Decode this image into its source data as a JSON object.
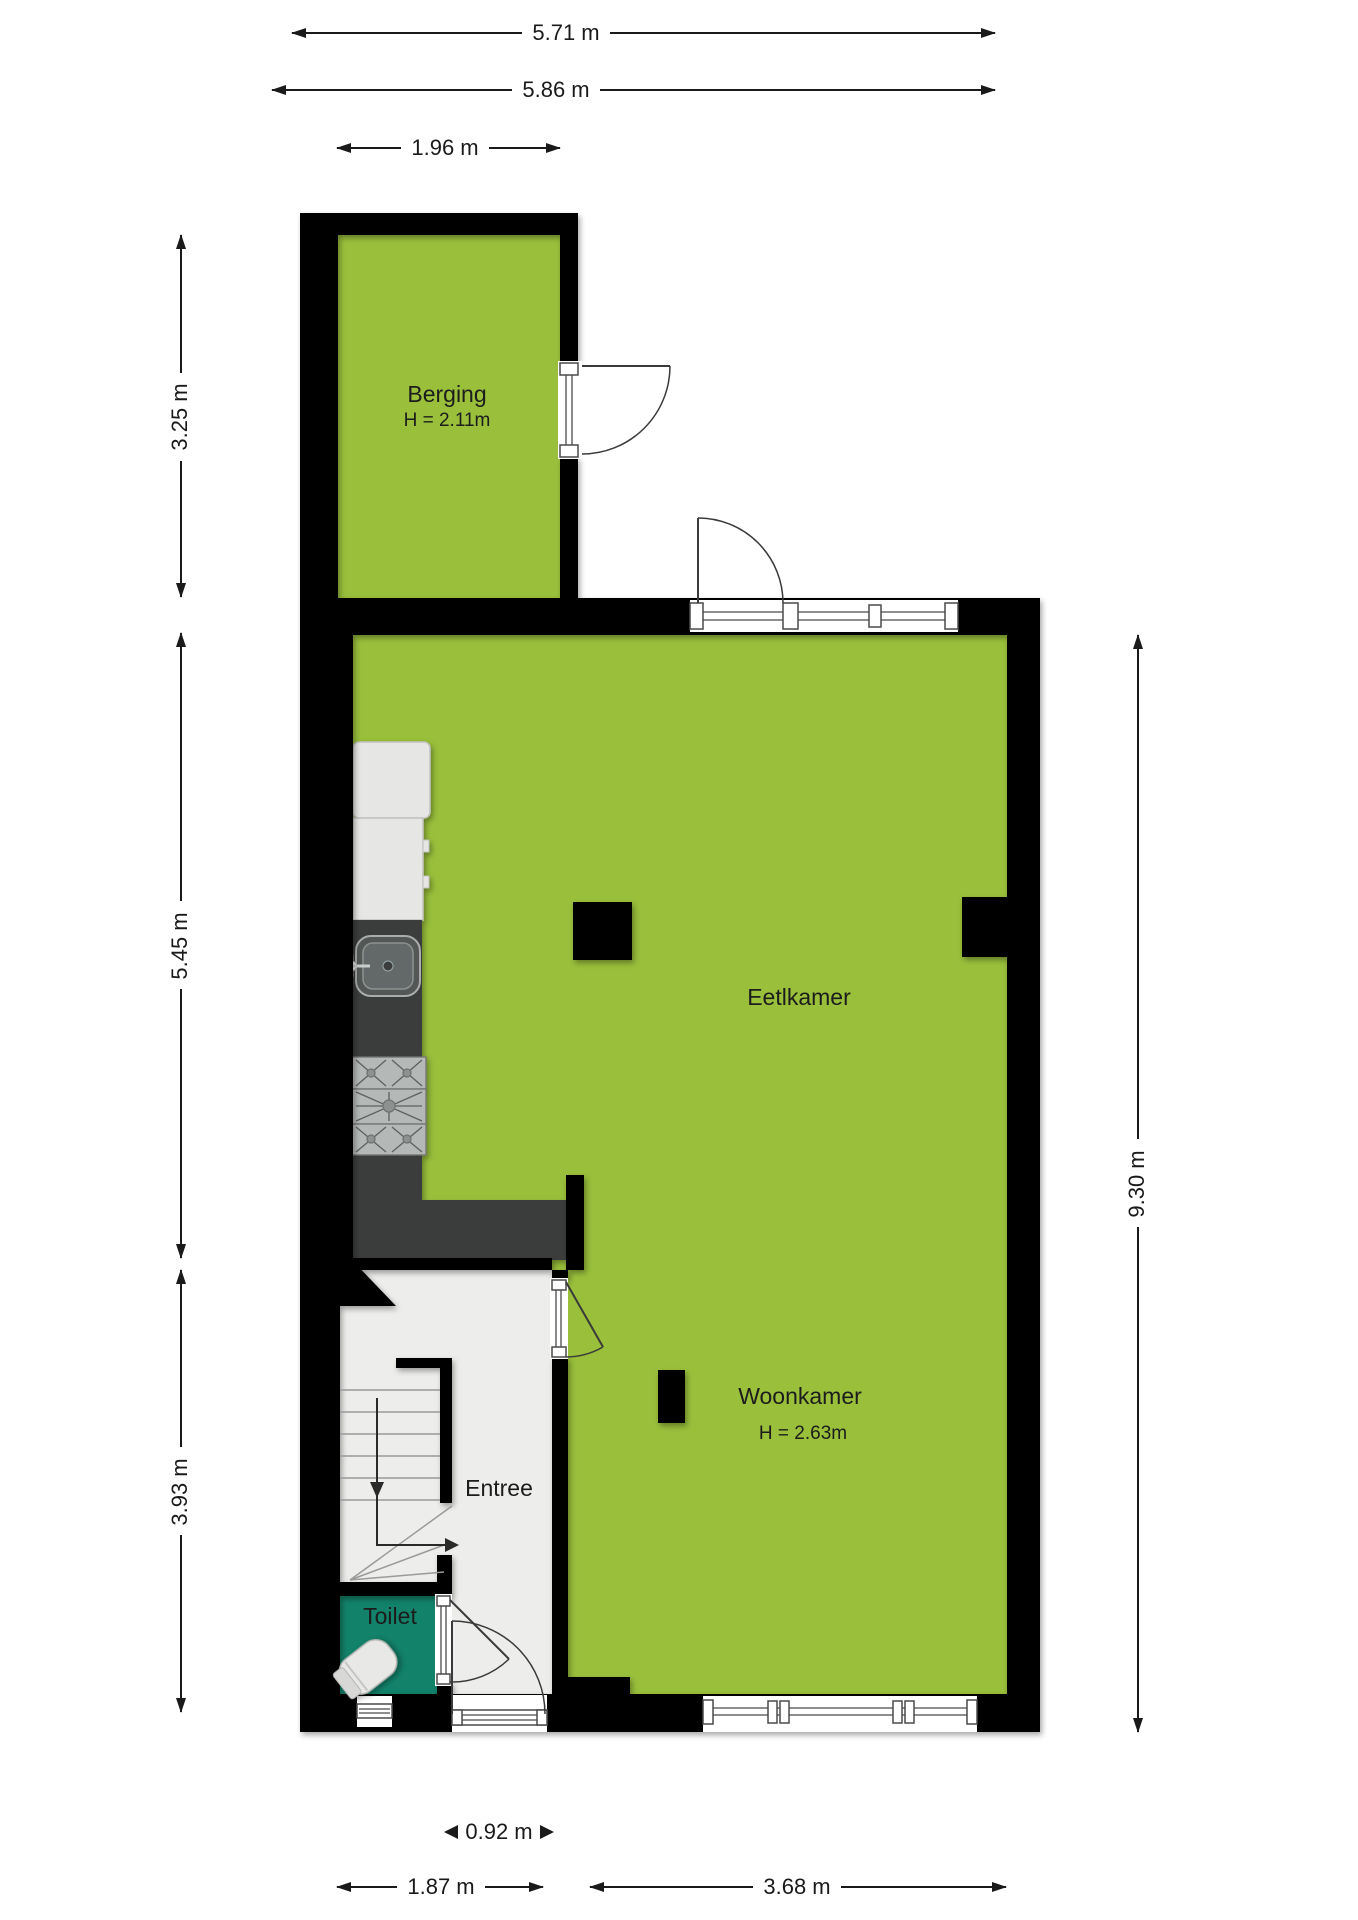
{
  "title": "Floor plan ground floor (begane grond)",
  "rooms": {
    "berging": {
      "name": "Berging",
      "height": "H = 2.11m"
    },
    "eetkamer": {
      "name": "Eetlkamer"
    },
    "woonkamer": {
      "name": "Woonkamer",
      "height": "H = 2.63m"
    },
    "entree": {
      "name": "Entree"
    },
    "toilet": {
      "name": "Toilet"
    }
  },
  "dimensions": {
    "top1": "5.71 m",
    "top2": "5.86 m",
    "top3": "1.96 m",
    "left1": "3.25 m",
    "left2": "5.45 m",
    "left3": "3.93 m",
    "right1": "9.30 m",
    "door_width": "0.92 m",
    "bottom1": "1.87 m",
    "bottom2": "3.68 m"
  },
  "colors": {
    "room_green": "#99BF3B",
    "toilet_teal": "#12826A",
    "wall_black": "#000000",
    "counter_dark": "#3B3D3C",
    "cabinet_gray": "#E6E6E4",
    "entree_floor": "#EDEDEB",
    "dimension_text": "#1a1a1a"
  }
}
